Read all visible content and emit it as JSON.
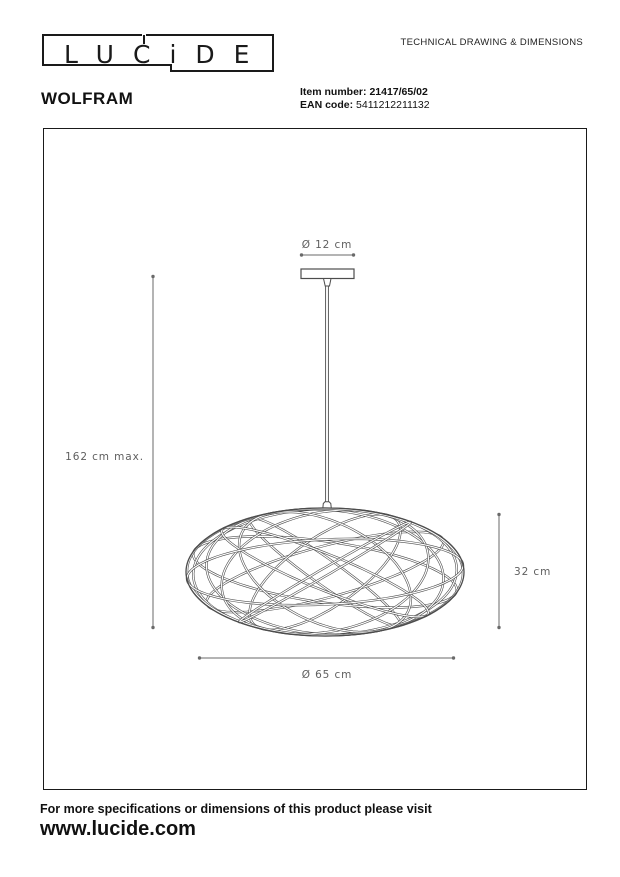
{
  "header": {
    "logo_letters": "LUCiDE",
    "doc_title": "TECHNICAL DRAWING & DIMENSIONS"
  },
  "product": {
    "name": "WOLFRAM",
    "item_number_label": "Item number:",
    "item_number": "21417/65/02",
    "ean_label": "EAN code:",
    "ean_code": "5411212211132"
  },
  "drawing": {
    "canopy_diameter": "Ø 12 cm",
    "max_height": "162 cm max.",
    "shade_height": "32 cm",
    "shade_diameter": "Ø 65 cm"
  },
  "footer": {
    "note": "For more specifications or dimensions of this product please visit",
    "website": "www.lucide.com"
  },
  "colors": {
    "ink": "#1a1a1a",
    "drawing_line": "#4d4d4d",
    "dimension_line": "#6a6a6a",
    "dimension_text": "#5f5f5f"
  }
}
